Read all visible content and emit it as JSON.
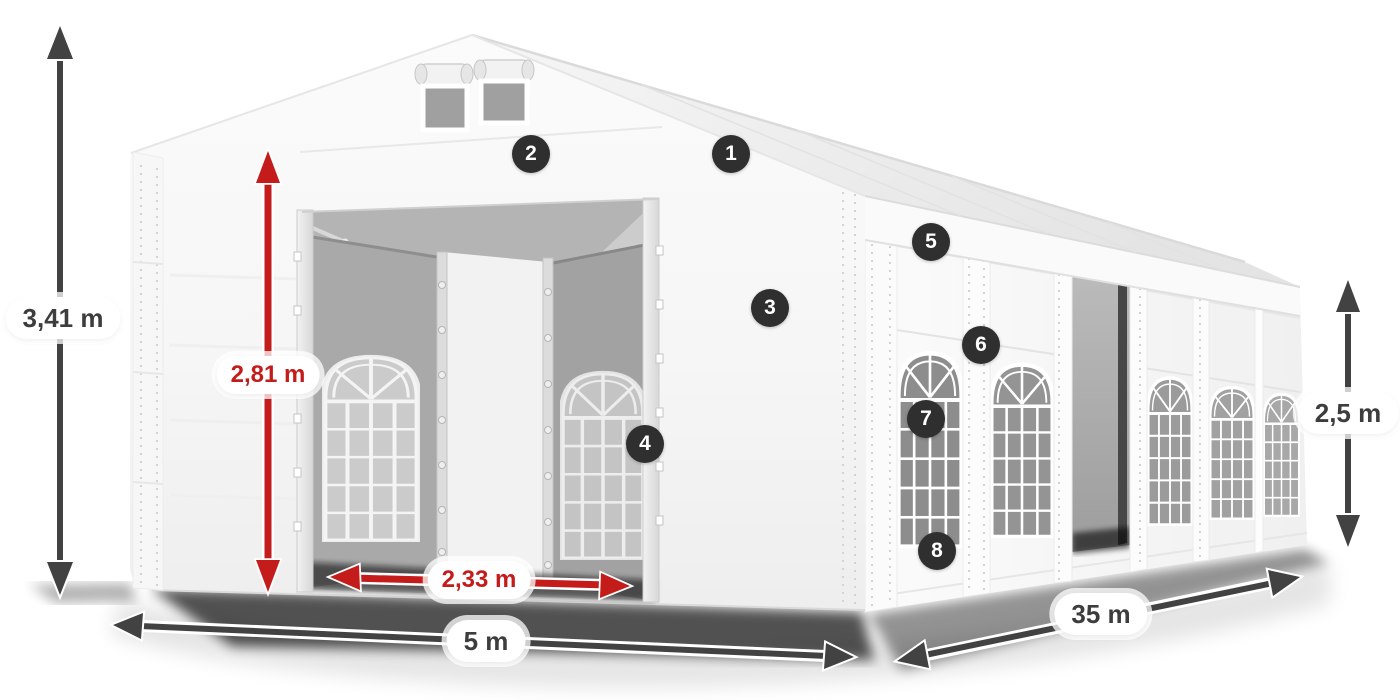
{
  "dimensions": {
    "total_height": "3,41 m",
    "entrance_height": "2,81 m",
    "entrance_width": "2,33 m",
    "width": "5 m",
    "length": "35 m",
    "side_height": "2,5 m"
  },
  "callouts": [
    "1",
    "2",
    "3",
    "4",
    "5",
    "6",
    "7",
    "8"
  ],
  "colors": {
    "accent_red": "#c41b1b",
    "arrow_gray": "#424242",
    "badge_bg": "#2f2f2f",
    "pill_bg": "#ffffff",
    "pill_text": "#3d3d3d"
  }
}
